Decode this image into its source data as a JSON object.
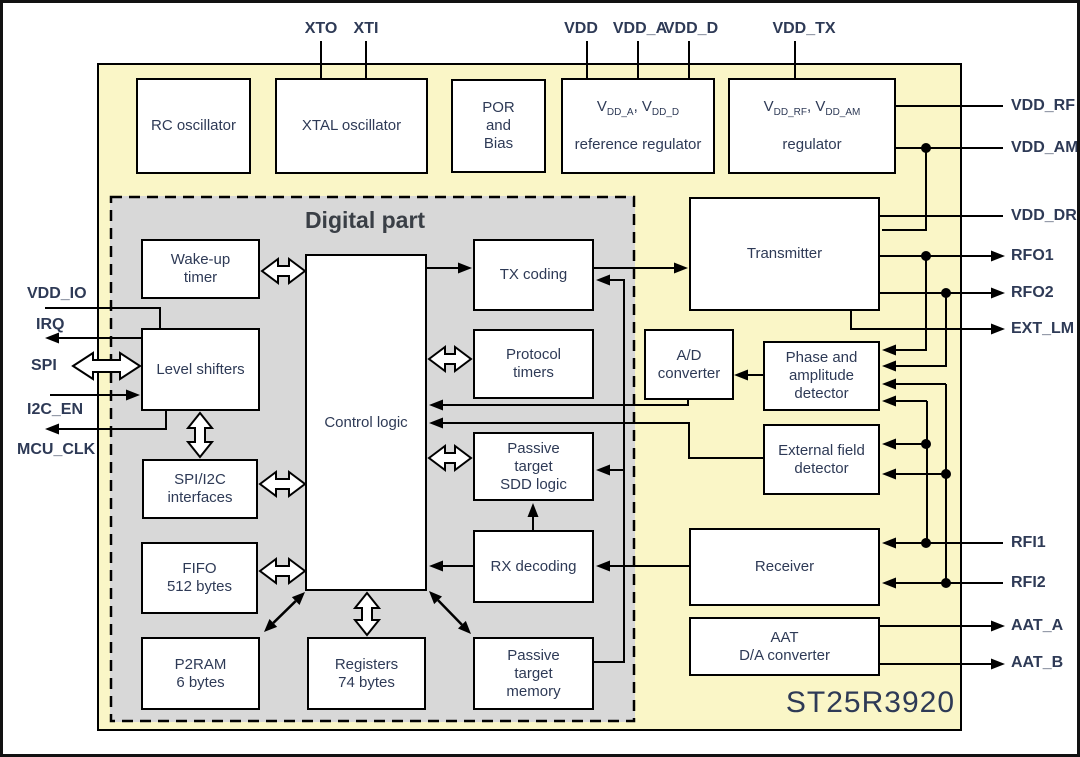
{
  "titles": {
    "digital_part": "Digital part",
    "chip": "ST25R3920"
  },
  "pins": {
    "top": [
      "XTO",
      "XTI",
      "VDD",
      "VDD_A",
      "VDD_D",
      "VDD_TX"
    ],
    "left": [
      "VDD_IO",
      "IRQ",
      "SPI",
      "I2C_EN",
      "MCU_CLK"
    ],
    "right": [
      "VDD_RF",
      "VDD_AM",
      "VDD_DR",
      "RFO1",
      "RFO2",
      "EXT_LM",
      "RFI1",
      "RFI2",
      "AAT_A",
      "AAT_B"
    ]
  },
  "blocks": {
    "rc_osc": "RC oscillator",
    "xtal_osc": "XTAL oscillator",
    "por": "POR\nand\nBias",
    "transmitter": "Transmitter",
    "wakeup": "Wake-up\ntimer",
    "level_shifters": "Level shifters",
    "spi_i2c": "SPI/I2C\ninterfaces",
    "fifo": "FIFO\n512 bytes",
    "p2ram": "P2RAM\n6 bytes",
    "registers": "Registers\n74 bytes",
    "control": "Control logic",
    "tx_coding": "TX coding",
    "protocol_timers": "Protocol\ntimers",
    "sdd": "Passive\ntarget\nSDD logic",
    "passive_mem": "Passive\ntarget\nmemory",
    "rx_decoding": "RX decoding",
    "ad_converter": "A/D\nconverter",
    "phase_amp": "Phase and\namplitude\ndetector",
    "ext_field": "External field\ndetector",
    "receiver": "Receiver",
    "aat": "AAT\nD/A converter"
  },
  "regulators": {
    "ref": {
      "v1": "V",
      "s1": "DD_A",
      "v2": ", V",
      "s2": "DD_D",
      "line2": "reference regulator"
    },
    "rf": {
      "v1": "V",
      "s1": "DD_RF",
      "v2": ", V",
      "s2": "DD_AM",
      "line2": "regulator"
    }
  },
  "colors": {
    "chip_bg": "#FAF6C7",
    "digital_bg": "#D8D8D8",
    "ink": "#2E3A56",
    "title_ink": "#3A3F46",
    "line": "#000000"
  }
}
